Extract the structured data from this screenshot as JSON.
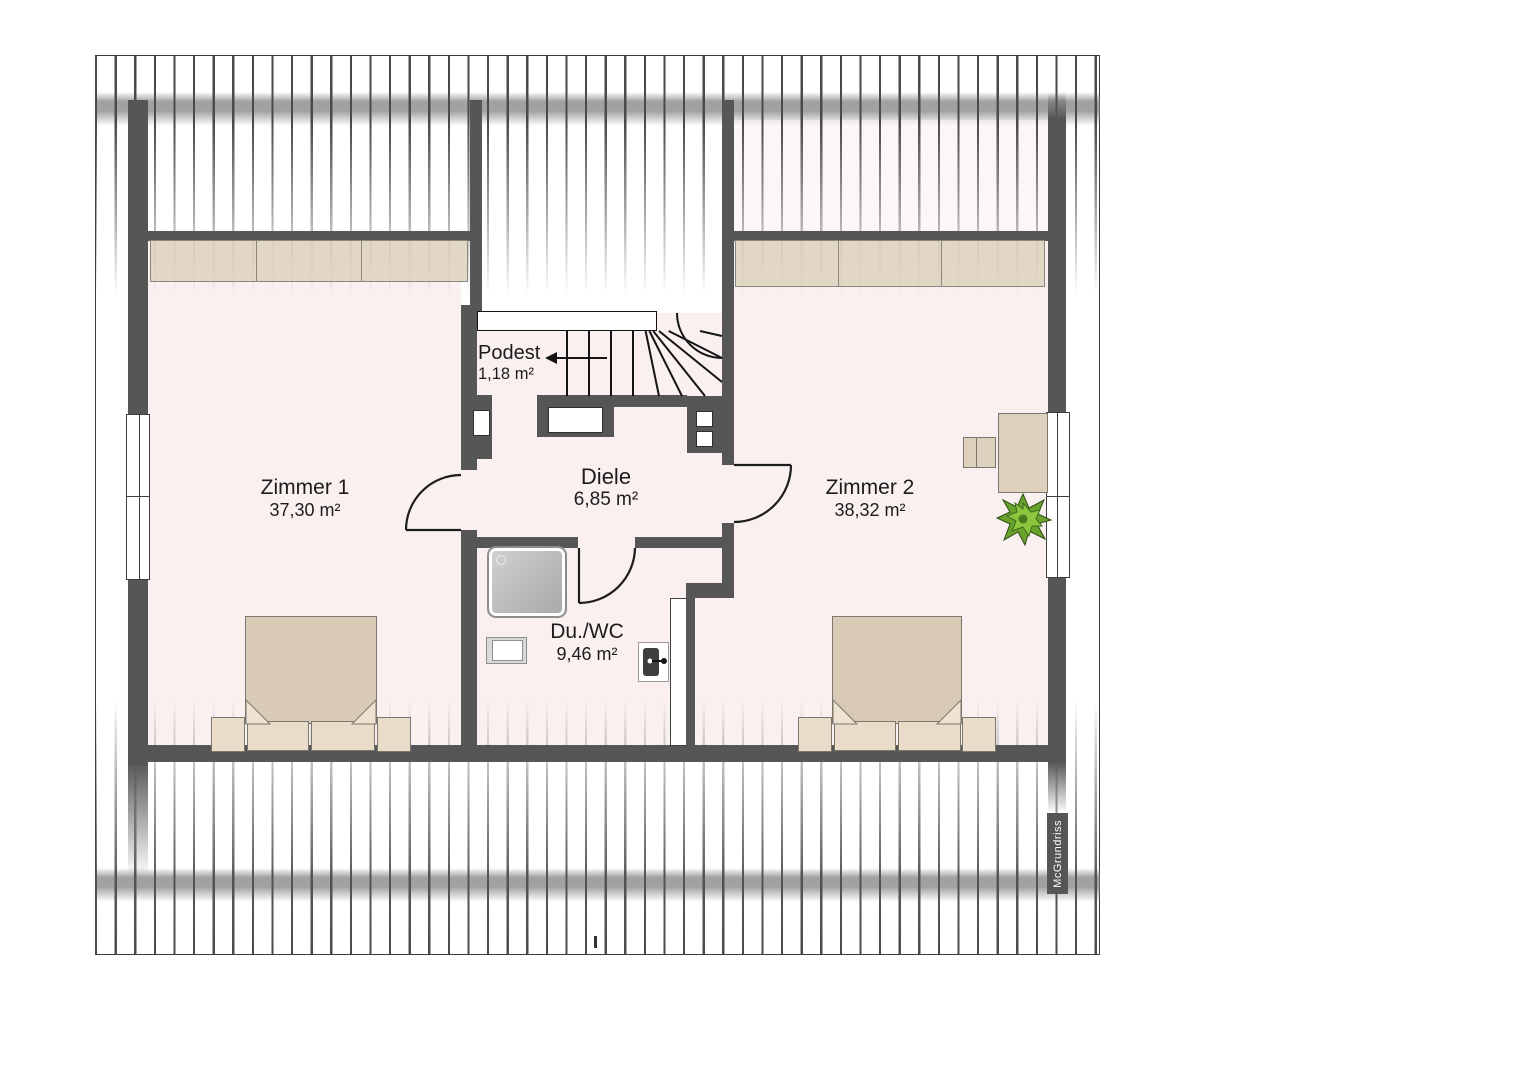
{
  "plan": {
    "title": "attic floor plan",
    "watermark": "McGrundriss",
    "rooms": [
      {
        "id": "zimmer1",
        "name": "Zimmer 1",
        "area": "37,30 m²"
      },
      {
        "id": "zimmer2",
        "name": "Zimmer 2",
        "area": "38,32 m²"
      },
      {
        "id": "diele",
        "name": "Diele",
        "area": "6,85 m²"
      },
      {
        "id": "duwc",
        "name": "Du./WC",
        "area": "9,46 m²"
      },
      {
        "id": "podest",
        "name": "Podest",
        "area": "1,18 m²"
      }
    ],
    "furniture": [
      "wardrobe",
      "double-bed",
      "nightstand",
      "pillow",
      "desk",
      "chair",
      "plant",
      "shower",
      "sink",
      "wc",
      "stairs",
      "window"
    ],
    "colors": {
      "floor": "#faf0f0",
      "wall": "#565656",
      "furniture_beige": "#ddd0bc",
      "duvet": "#d8cab5",
      "plant_green": "#69a32c",
      "hatch_line": "#4a4a4a"
    }
  }
}
